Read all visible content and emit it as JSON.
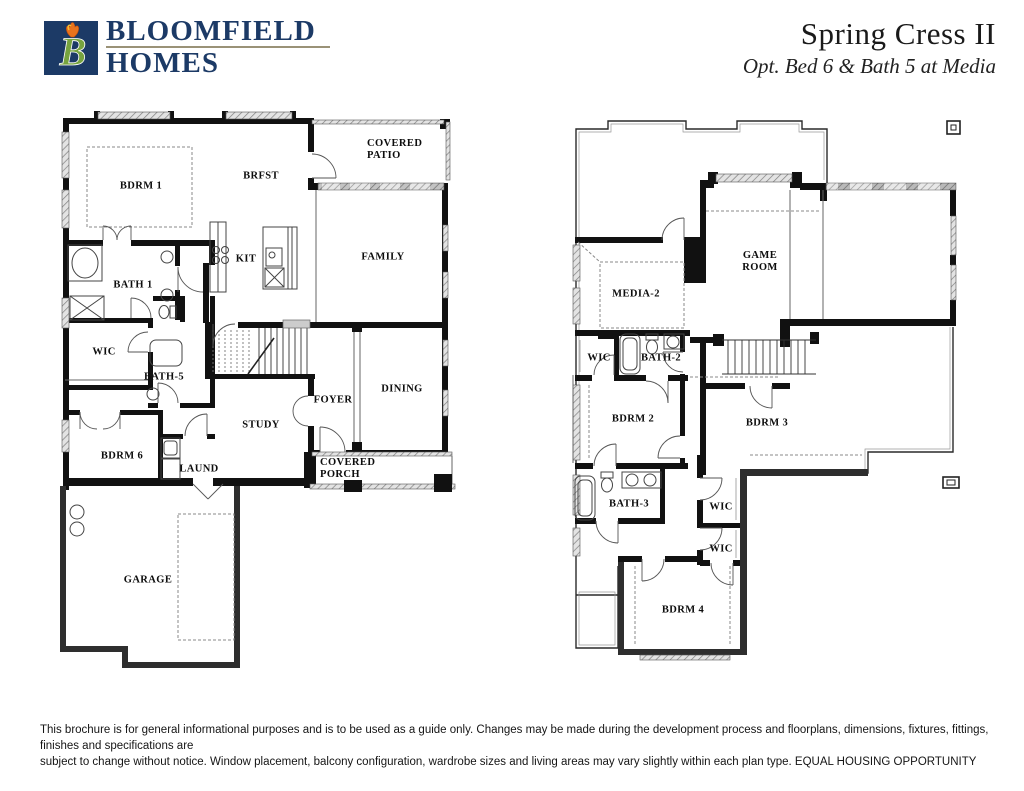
{
  "header": {
    "logo_letter": "B",
    "brand_line1": "BLOOMFIELD",
    "brand_line2": "HOMES",
    "title": "Spring Cress II",
    "subtitle": "Opt. Bed 6 & Bath 5 at Media"
  },
  "floor1": {
    "rooms": {
      "bdrm1": "BDRM 1",
      "brfst": "BRFST",
      "covered_patio": "COVERED PATIO",
      "family": "FAMILY",
      "bath1": "BATH 1",
      "kit": "KIT",
      "wic": "WIC",
      "bath5": "BATH-5",
      "bdrm6": "BDRM 6",
      "laund": "LAUND",
      "study": "STUDY",
      "foyer": "FOYER",
      "dining": "DINING",
      "covered_porch": "COVERED PORCH",
      "garage": "GARAGE"
    }
  },
  "floor2": {
    "rooms": {
      "media2": "MEDIA-2",
      "game_room": "GAME ROOM",
      "wic_a": "WIC",
      "bath2": "BATH-2",
      "bdrm2": "BDRM 2",
      "bdrm3": "BDRM 3",
      "bath3": "BATH-3",
      "wic_b": "WIC",
      "wic_c": "WIC",
      "bdrm4": "BDRM 4"
    }
  },
  "footer": {
    "disclaimer_line1": "This brochure is for general informational purposes and is to be used as a guide only. Changes may be made during the development process and floorplans, dimensions, fixtures, fittings, finishes and specifications are",
    "disclaimer_line2": "subject to change without notice. Window placement, balcony configuration, wardrobe sizes and living areas may vary slightly within each plan type.  EQUAL HOUSING OPPORTUNITY"
  },
  "colors": {
    "brand_navy": "#1c3a66",
    "logo_green": "#76a33f",
    "logo_tulip": "#e8731d",
    "underline_gold": "#9a9277",
    "wall_black": "#111111"
  }
}
